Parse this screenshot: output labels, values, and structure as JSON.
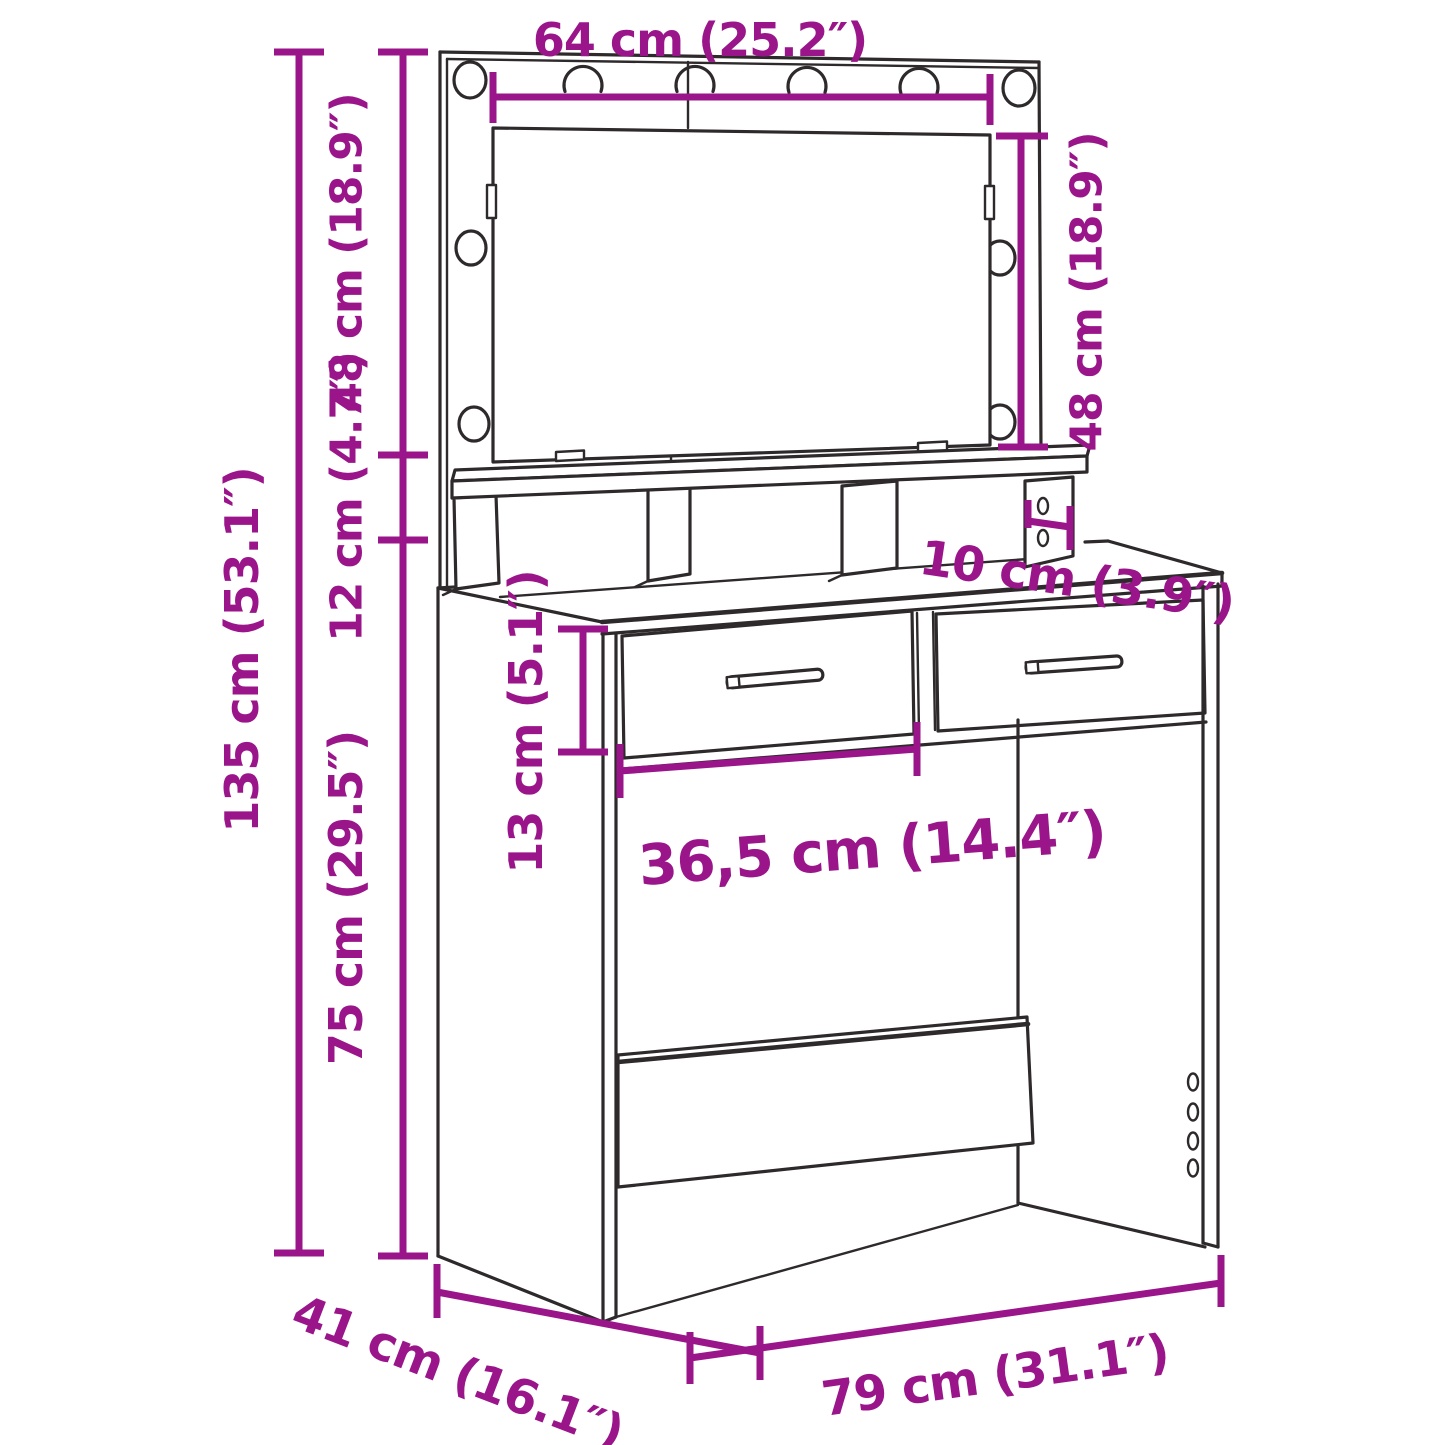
{
  "colors": {
    "dimension": "#9a148a",
    "outline": "#2e2a2c",
    "background": "#ffffff"
  },
  "dimensions": {
    "mirror_width": {
      "label": "64 cm (25.2″)"
    },
    "mirror_height_right": {
      "label": "48 cm (18.9″)"
    },
    "mirror_height_left": {
      "label": "48 cm (18.9″)"
    },
    "hutch_height": {
      "label": "12 cm (4.7″)"
    },
    "total_height": {
      "label": "135 cm (53.1″)"
    },
    "table_height": {
      "label": "75 cm (29.5″)"
    },
    "drawer_height": {
      "label": "13 cm (5.1″)"
    },
    "drawer_width": {
      "label": "36,5 cm (14.4″)"
    },
    "hutch_depth": {
      "label": "10 cm (3.9″)"
    },
    "depth": {
      "label": "41 cm (16.1″)"
    },
    "width": {
      "label": "79 cm (31.1″)"
    }
  }
}
